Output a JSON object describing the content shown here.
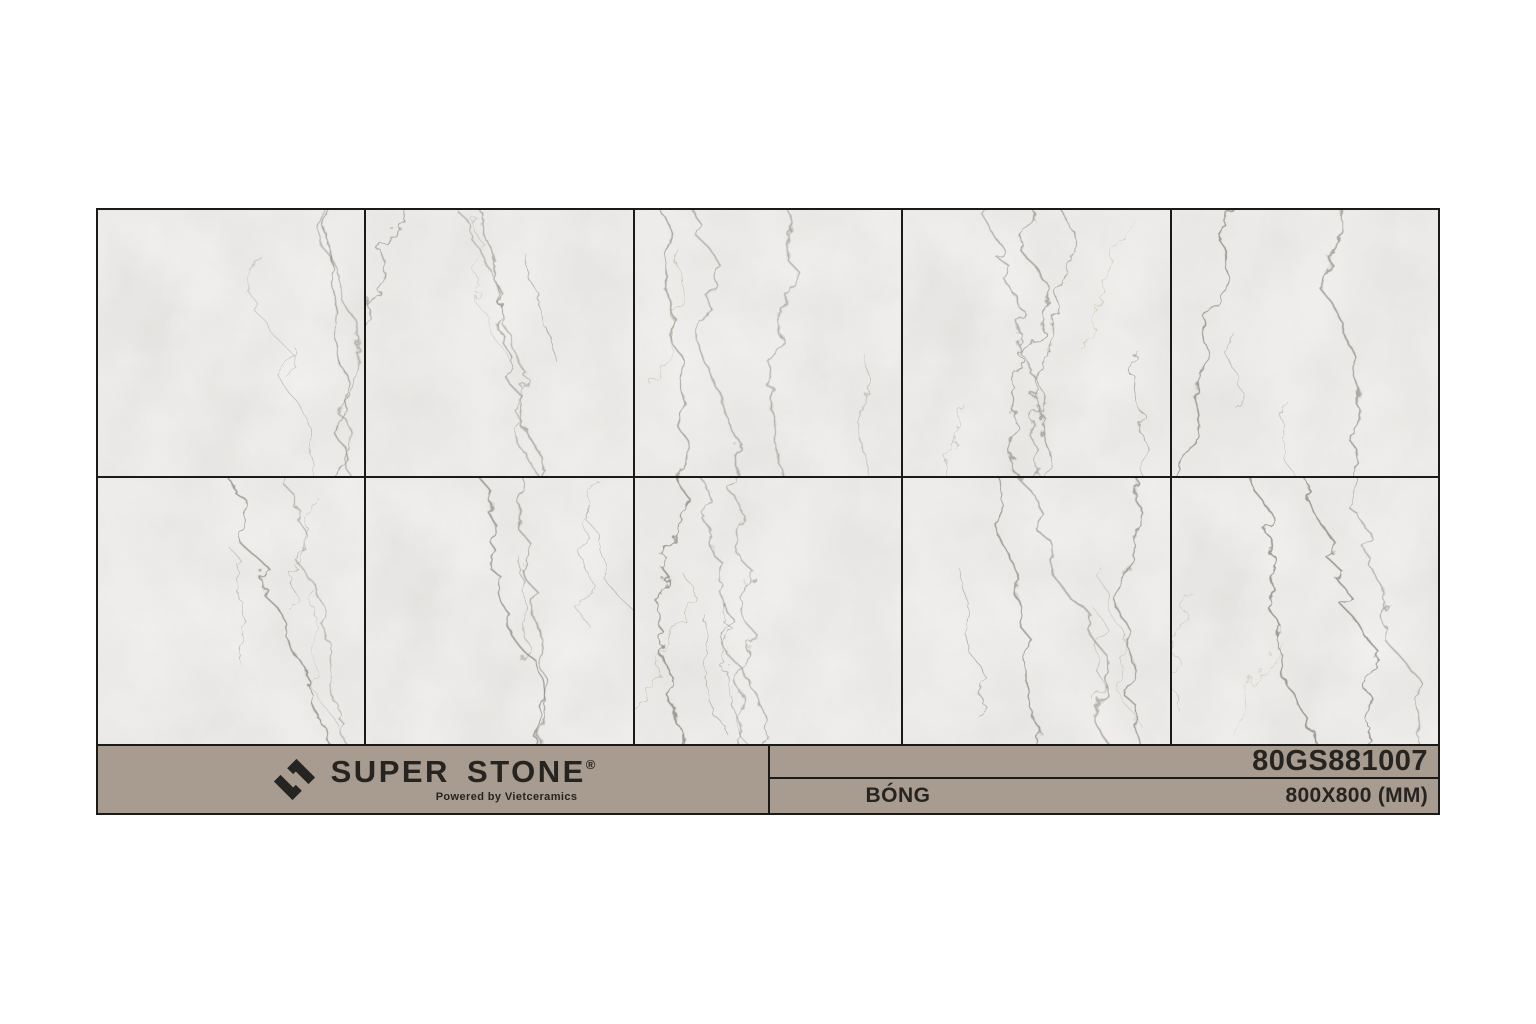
{
  "brand": {
    "name": "SUPER STONE",
    "registered_mark": "®",
    "tagline": "Powered by Vietceramics"
  },
  "product": {
    "code": "80GS881007",
    "finish": "BÓNG",
    "size": "800X800 (MM)"
  },
  "tiles": {
    "rows": 2,
    "cols": 5,
    "description": "marble-swatch-grid"
  },
  "colors": {
    "page_bg": "#ffffff",
    "footer_bg": "#a89b90",
    "line": "#1c1a18",
    "tile_base": "#edecea",
    "text_dark": "#262421"
  }
}
